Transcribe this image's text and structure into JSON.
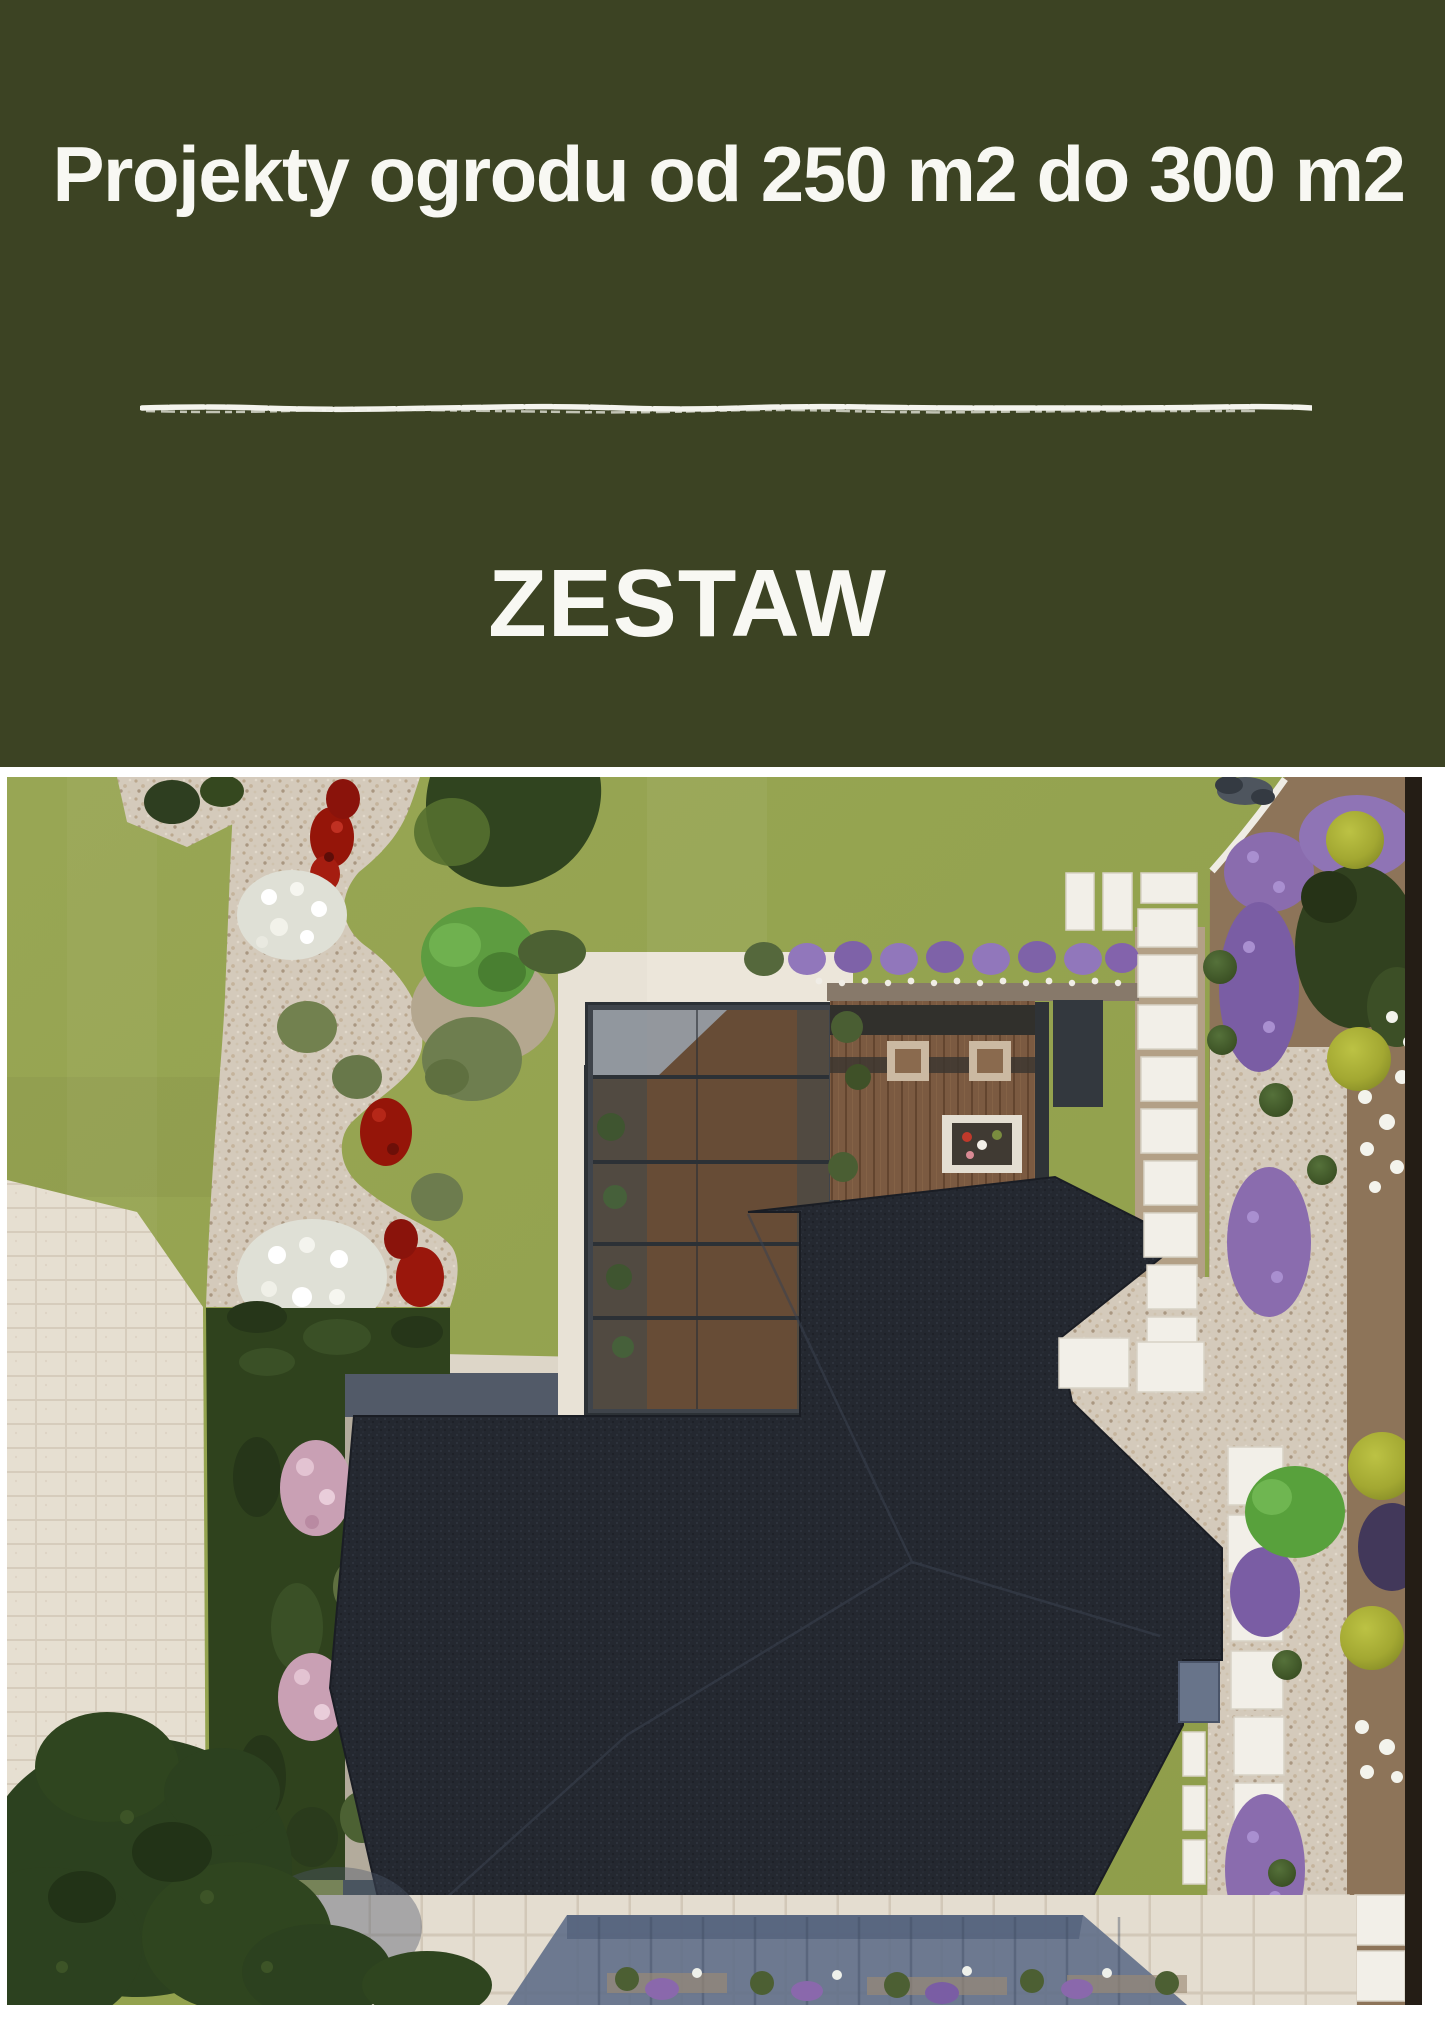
{
  "header": {
    "title": "Projekty ogrodu od 250 m2 do 300 m2",
    "subtitle": "ZESTAW",
    "background_color": "#3c4323",
    "text_color": "#f8f8f3",
    "divider_style": "hand-drawn white chalk line"
  },
  "photo": {
    "alt": "Top-down 3D visualization of a garden design: house with dark charcoal hip roof, glass conservatory, wooden terrace with table and plant row, lawn, winding gravel flower beds with red, white and purple flowers, clipped hedges, trees, pale paved driveway and white stepping-stone paths",
    "palette": {
      "lawn": "#95a452",
      "roof": "#242830",
      "gravel": "#d4cabb",
      "pavers": "#e6dfd1",
      "deck_wood": "#7b5a41",
      "hedge": "#2f421d",
      "red_flowers": "#951509",
      "white_flowers": "#f3f3ec",
      "purple_flowers": "#8a6cae",
      "yellow_green_shrubs": "#a3a832",
      "walkway_shadow": "#5c6b86"
    }
  }
}
